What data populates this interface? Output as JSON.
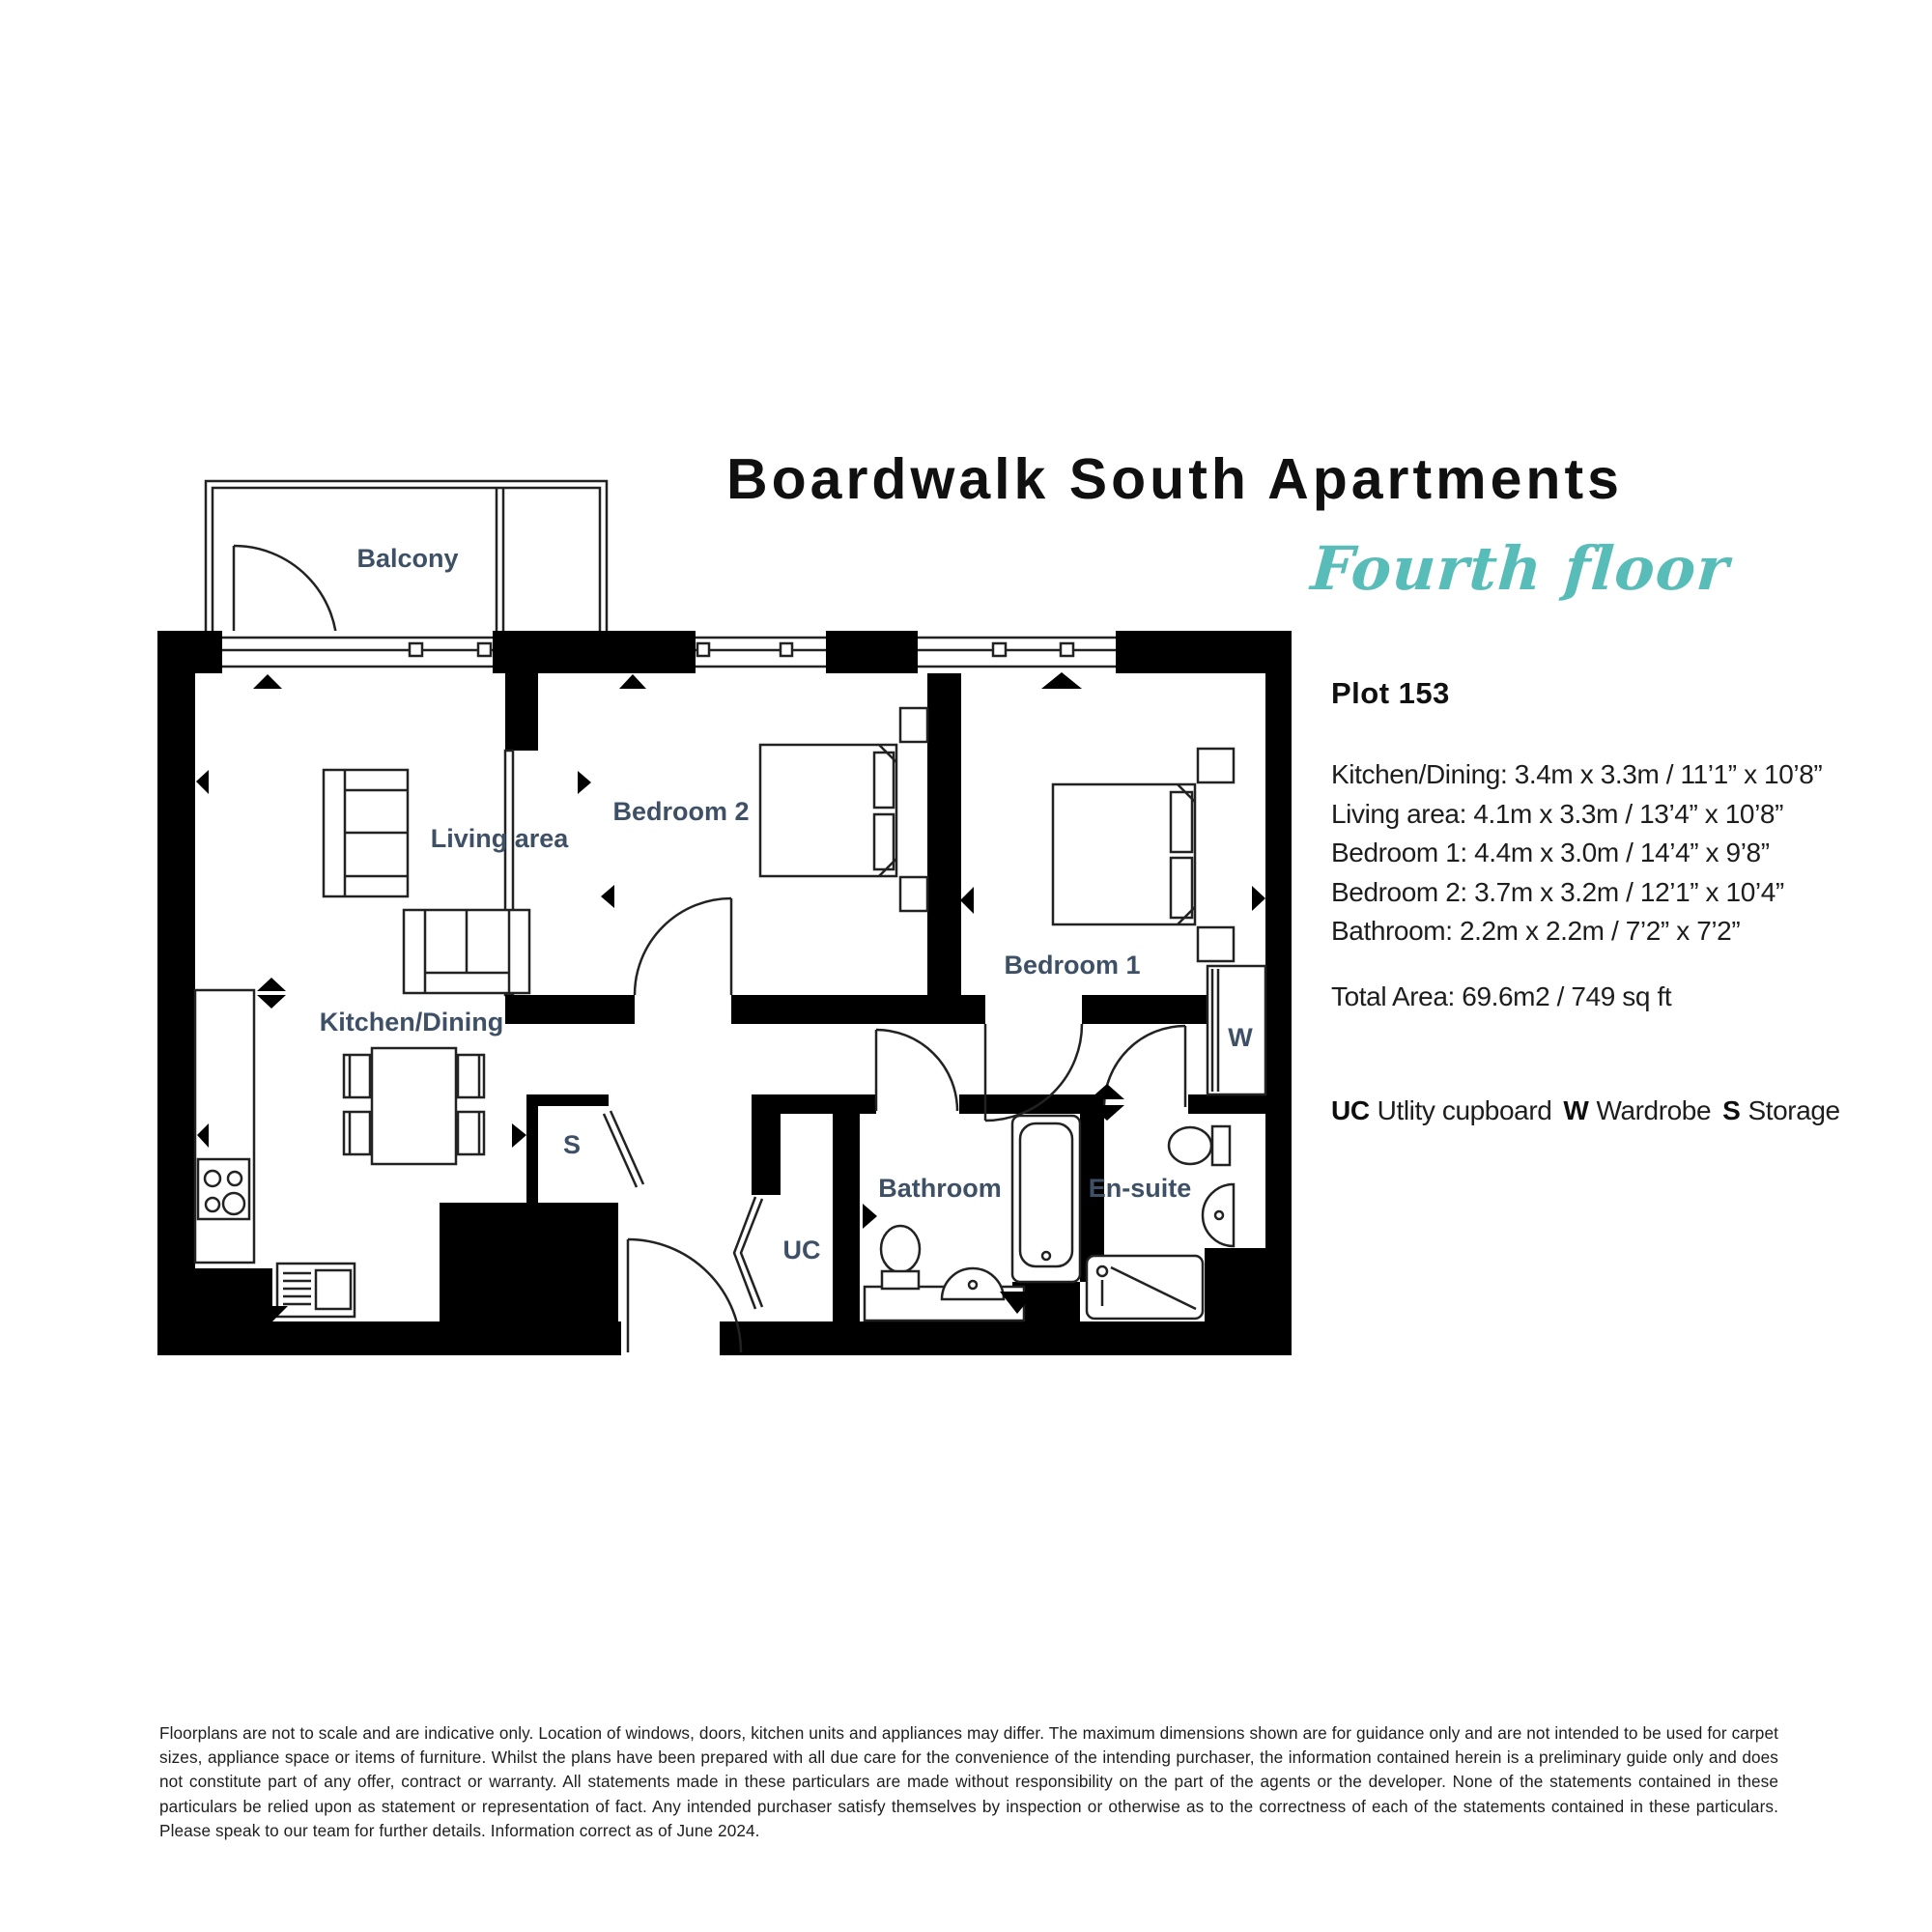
{
  "header": {
    "title": "Boardwalk South Apartments",
    "floor": "Fourth floor",
    "plot": "Plot 153"
  },
  "dims": [
    "Kitchen/Dining: 3.4m x 3.3m / 11’1” x 10’8”",
    "Living area: 4.1m x 3.3m / 13’4” x 10’8”",
    "Bedroom 1: 4.4m x 3.0m / 14’4” x 9’8”",
    "Bedroom 2: 3.7m x 3.2m / 12’1” x 10’4”",
    "Bathroom: 2.2m x 2.2m / 7’2” x 7’2”"
  ],
  "total_area": "Total Area: 69.6m2 / 749 sq ft",
  "legend": [
    {
      "abbr": "UC",
      "label": "Utlity cupboard"
    },
    {
      "abbr": "W",
      "label": "Wardrobe"
    },
    {
      "abbr": "S",
      "label": "Storage"
    }
  ],
  "rooms": {
    "balcony": "Balcony",
    "living": "Living area",
    "kitchen": "Kitchen/Dining",
    "bedroom2": "Bedroom 2",
    "bedroom1": "Bedroom 1",
    "bathroom": "Bathroom",
    "ensuite": "En-suite",
    "uc": "UC",
    "wardrobe": "W",
    "storage": "S"
  },
  "disclaimer": "Floorplans are not to scale and are indicative only. Location of windows, doors, kitchen units and appliances may differ. The maximum dimensions shown are for guidance only and are not intended to be used for carpet sizes, appliance space or items of furniture. Whilst the plans have been prepared with all due care for the convenience of the intending purchaser, the information contained herein is a preliminary guide only and does not constitute part of any offer, contract or warranty. All statements made in these particulars are made without responsibility on the part of the agents or the developer. None of the statements contained in these particulars be relied upon as statement or representation of fact. Any intended purchaser satisfy themselves by inspection or otherwise as to the correctness of each of the statements contained in these particulars. Please speak to our team for further details. Information correct as of June 2024.",
  "colors": {
    "accent_teal": "#58bcb8",
    "room_label": "#3e5066",
    "wall": "#000000"
  }
}
